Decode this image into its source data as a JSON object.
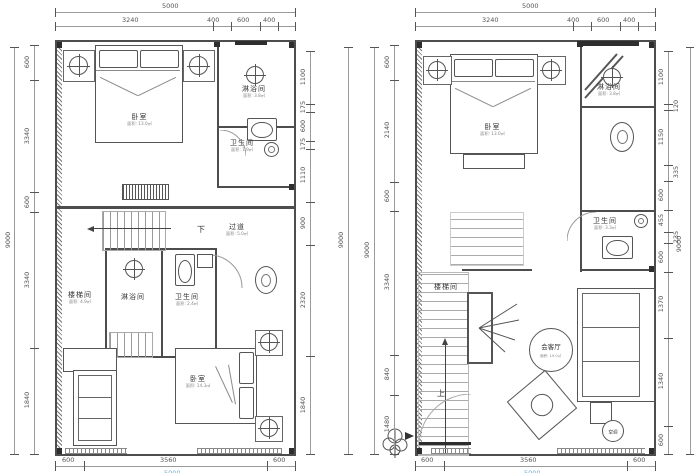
{
  "left": {
    "dims": {
      "top_total": "5000",
      "top_segments": [
        "3240",
        "400",
        "600",
        "400"
      ],
      "left_total": "9000",
      "left_segments": [
        "600",
        "3340",
        "600",
        "3340",
        "1840"
      ],
      "right_segments": [
        "1100",
        "175",
        "600",
        "175",
        "1110",
        "900",
        "2320",
        "1840"
      ],
      "right_total": "9000",
      "bottom_segments": [
        "600",
        "3560",
        "600"
      ],
      "bottom_total": "5000"
    },
    "labels": {
      "bedroom_top": "卧室",
      "bedroom_top_area": "面积: 13.0㎡",
      "shower_top": "淋浴间",
      "shower_top_area": "面积: 3.8㎡",
      "toilet_top": "卫生间",
      "toilet_top_area": "面积: 1.9㎡",
      "down": "下",
      "corridor": "过道",
      "corridor_area": "面积: 5.0㎡",
      "stairwell": "楼梯间",
      "stairwell_area": "面积: 4.9㎡",
      "shower_mid": "淋浴间",
      "toilet_mid": "卫生间",
      "toilet_mid_area": "面积: 2.4㎡",
      "bedroom_bottom": "卧室",
      "bedroom_bottom_area": "面积: 14.3㎡"
    }
  },
  "right": {
    "dims": {
      "top_total": "5000",
      "top_segments": [
        "3240",
        "400",
        "600",
        "400"
      ],
      "left_total": "9000",
      "left_segments": [
        "600",
        "2140",
        "600",
        "3340",
        "840",
        "1480"
      ],
      "right_segments": [
        "1100",
        "120",
        "1150",
        "335",
        "600",
        "455",
        "235",
        "600",
        "1370",
        "1340",
        "600"
      ],
      "right_total": "9000",
      "bottom_segments": [
        "600",
        "3560",
        "600"
      ],
      "bottom_total": "5000"
    },
    "labels": {
      "bedroom_top": "卧室",
      "bedroom_top_area": "面积: 13.0㎡",
      "shower_top": "淋浴间",
      "shower_top_area": "面积: 3.8㎡",
      "toilet": "卫生间",
      "toilet_area": "面积: 3.3㎡",
      "stairwell": "楼梯间",
      "up": "上",
      "living": "会客厅",
      "living_area": "面积: 19.0㎡",
      "ac": "空调"
    }
  },
  "colors": {
    "wall": "#4d4d4d",
    "line": "#8a8a8a",
    "dim_text": "#555555",
    "total_blue": "#7ab0d4"
  }
}
